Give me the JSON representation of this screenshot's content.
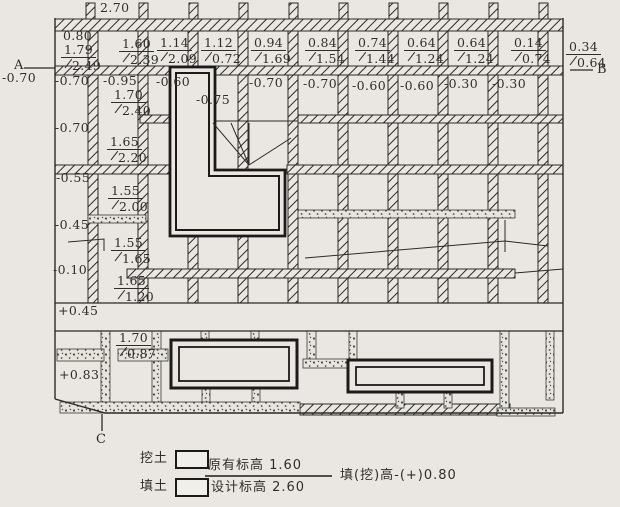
{
  "drawing": {
    "corner_elevation": "2.70",
    "axes": {
      "a": "A",
      "a_value": "-0.70",
      "b": "B",
      "c": "C"
    },
    "row1": [
      {
        "height": "0.80",
        "orig": "1.79",
        "design": "2.49"
      },
      {
        "orig": "1.60",
        "design": "2.39"
      },
      {
        "orig": "1.14",
        "design": "2.09"
      },
      {
        "orig": "1.12",
        "design": "0.72"
      },
      {
        "orig": "0.94",
        "design": "1.69"
      },
      {
        "orig": "0.84",
        "design": "1.54"
      },
      {
        "orig": "0.74",
        "design": "1.44"
      },
      {
        "orig": "0.64",
        "design": "1.24"
      },
      {
        "orig": "0.64",
        "design": "1.24"
      },
      {
        "orig": "0.14",
        "design": "0.74"
      },
      {
        "orig": "0.34",
        "design": "0.64"
      }
    ],
    "row2": [
      "-0.70",
      "-0.95",
      "-0.60",
      "-0.75",
      "-0.70",
      "-0.70",
      "-0.60",
      "-0.60",
      "-0.30",
      "-0.30"
    ],
    "row2_fraction": {
      "orig": "1.70",
      "design": "2.40"
    },
    "west_heights": [
      "-0.70",
      "-0.55",
      "-0.45",
      "-0.10"
    ],
    "west_fractions": [
      {
        "orig": "1.65",
        "design": "2.20"
      },
      {
        "orig": "1.55",
        "design": "2.00"
      },
      {
        "orig": "1.55",
        "design": "1.65"
      },
      {
        "orig": "1.65",
        "design": "1.20"
      }
    ],
    "band_height": "+0.45",
    "south_fraction": {
      "orig": "1.70",
      "design": "0.87"
    },
    "south_height": "+0.83"
  },
  "legend": {
    "cut_label": "挖土",
    "fill_label": "填土",
    "original_elevation": "原有标高 1.60",
    "design_elevation": "设计标高 2.60",
    "note": "填(挖)高-(+)0.80"
  },
  "colors": {
    "paper": "#eae7e2",
    "ink": "#2b2a28"
  }
}
